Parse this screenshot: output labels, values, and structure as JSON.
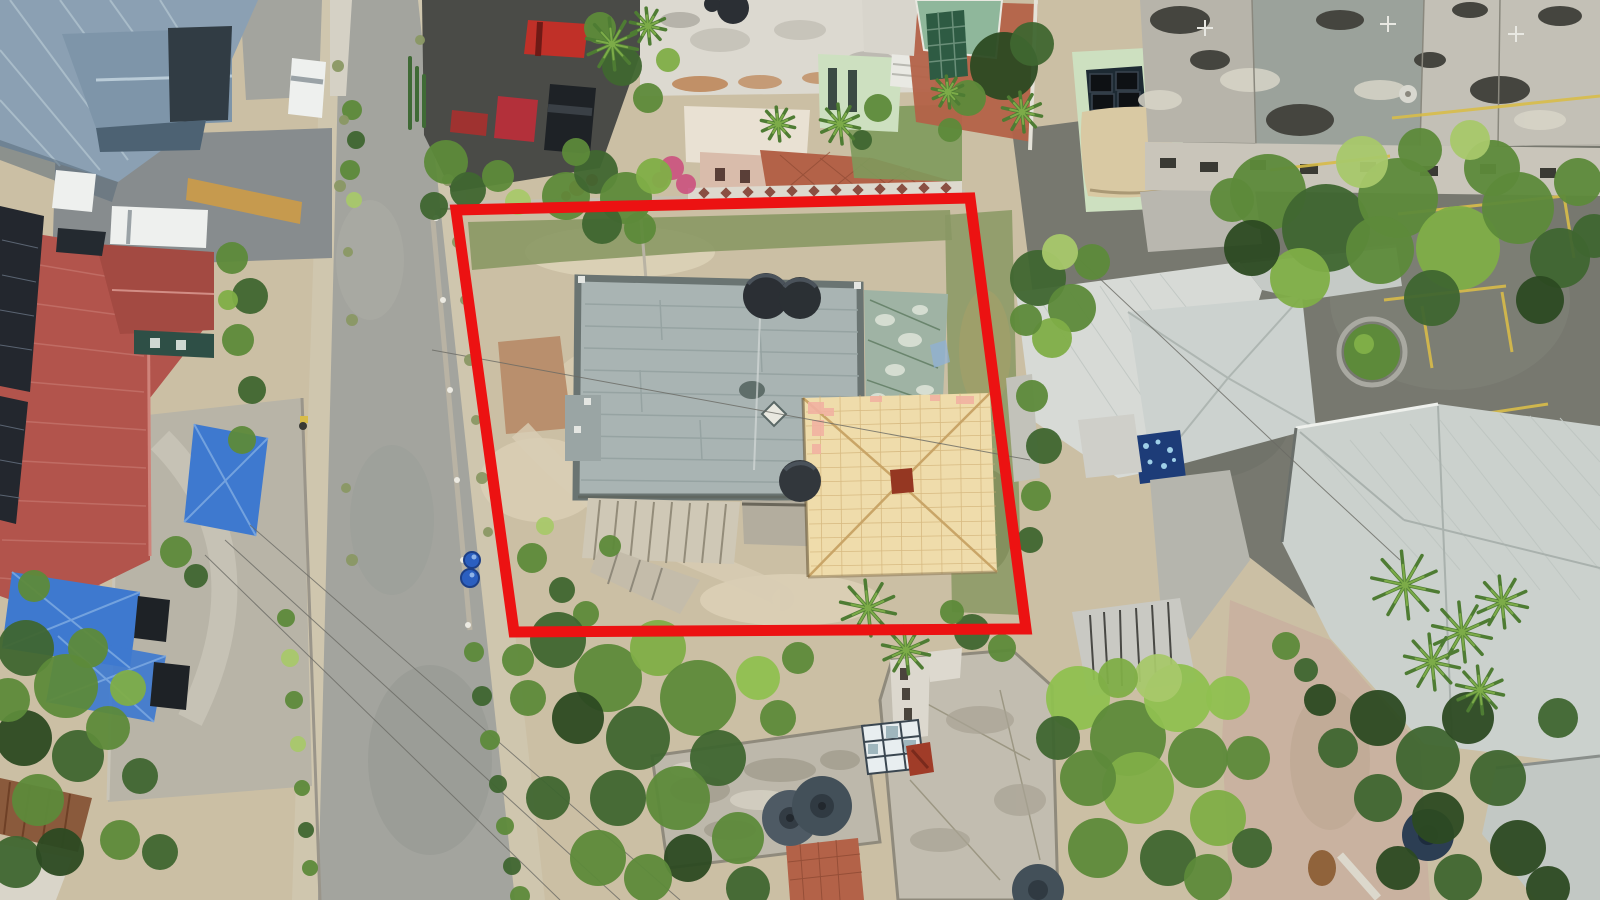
{
  "annotation": {
    "type": "property-boundary-outline",
    "points": "456,210 970,198 1026,629 514,632",
    "color": "#ec1212",
    "stroke_width": 11
  },
  "palette": {
    "ground_sand": "#cbbfa4",
    "dirt_light": "#ddd2b8",
    "dirt_red": "#b98f6d",
    "dirt_pink": "#c9b2a0",
    "grass_dull": "#8a9864",
    "lawn_green": "#7e9a5c",
    "road_gray": "#a3a49e",
    "road_dust": "#cfc6ae",
    "asphalt_dark": "#4a4b47",
    "asphalt_mid": "#77786f",
    "drive_gray": "#878c8e",
    "gravel": "#b8b4a7",
    "flat_roof_gray": "#a9b4b3",
    "parapet_dark": "#6a7472",
    "shed_green": "#9fb3a4",
    "orange_roof": "#efdcab",
    "orange_roof_line": "#d0af74",
    "chimney_rust": "#953722",
    "salmon_patch": "#f2b2a2",
    "roof_white": "#dcd9d0",
    "concrete_weathered": "#b7b4aa",
    "concrete_roof": "#bdb8ab",
    "metal_roof_white": "#d7dad6",
    "metal_roof_right": "#cbd1cd",
    "bluegray_roof": "#8ba0b3",
    "dark_roof": "#313c44",
    "red_roof": "#b2544c",
    "red_roof_dark": "#a34a42",
    "solar_dark": "#23272e",
    "tarp_blue": "#3e79cf",
    "pool_green": "#8fb79b",
    "pool_cover": "#2e5b43",
    "terracotta": "#b36248",
    "sail_tan": "#d9c9a3",
    "green_wall": "#cde0c0",
    "skylight_blue": "#9fb6bd",
    "tank_dark": "#2b2f34",
    "tank_gray": "#4e5a64",
    "tank_navy": "#2c3e53",
    "car_white": "#eef0ee",
    "car_red": "#c03028",
    "car_red2": "#b3303a",
    "car_dark": "#1e2226",
    "barrel_blue": "#2b5fc0",
    "yellow_line": "#d8bc49",
    "wall_light": "#c6c0b2",
    "ochre_wall": "#c69a4e",
    "rust_roof": "#8a5a3c",
    "pink_flower": "#cc4b7d",
    "flower_red": "#c2352b",
    "dumpster_blue": "#1d3c78",
    "tree_dark": "#3f6630",
    "tree_mid": "#5d8a3a",
    "tree_light": "#7fae47",
    "tree_bright": "#8fc050",
    "tree_yellow": "#a8c86a",
    "tree_deep": "#2c4a22",
    "palm_green": "#4e7c33",
    "palm_light": "#7cab48"
  },
  "scene": {
    "tree_color_keys": {
      "d": "tree_dark",
      "m": "tree_mid",
      "l": "tree_light",
      "b": "tree_bright",
      "y": "tree_yellow",
      "v": "tree_deep",
      "g": "grass_dull"
    },
    "trees": [
      [
        352,
        110,
        10,
        "m"
      ],
      [
        356,
        140,
        9,
        "d"
      ],
      [
        350,
        170,
        10,
        "m"
      ],
      [
        354,
        200,
        8,
        "y"
      ],
      [
        232,
        258,
        16,
        "m"
      ],
      [
        250,
        296,
        18,
        "d"
      ],
      [
        238,
        340,
        16,
        "m"
      ],
      [
        252,
        390,
        14,
        "d"
      ],
      [
        242,
        440,
        14,
        "m"
      ],
      [
        228,
        300,
        10,
        "l"
      ],
      [
        176,
        552,
        16,
        "m"
      ],
      [
        196,
        576,
        12,
        "d"
      ],
      [
        26,
        648,
        28,
        "d"
      ],
      [
        66,
        686,
        32,
        "m"
      ],
      [
        24,
        738,
        28,
        "v"
      ],
      [
        78,
        756,
        26,
        "d"
      ],
      [
        38,
        800,
        26,
        "m"
      ],
      [
        108,
        728,
        22,
        "m"
      ],
      [
        128,
        688,
        18,
        "l"
      ],
      [
        88,
        648,
        20,
        "m"
      ],
      [
        16,
        862,
        26,
        "d"
      ],
      [
        140,
        776,
        18,
        "d"
      ],
      [
        60,
        852,
        24,
        "v"
      ],
      [
        120,
        840,
        20,
        "m"
      ],
      [
        160,
        852,
        18,
        "d"
      ],
      [
        34,
        586,
        16,
        "m"
      ],
      [
        8,
        700,
        22,
        "m"
      ],
      [
        286,
        618,
        9,
        "m"
      ],
      [
        290,
        658,
        9,
        "y"
      ],
      [
        294,
        700,
        9,
        "m"
      ],
      [
        298,
        744,
        8,
        "y"
      ],
      [
        302,
        788,
        8,
        "m"
      ],
      [
        306,
        830,
        8,
        "d"
      ],
      [
        310,
        868,
        8,
        "m"
      ],
      [
        474,
        652,
        10,
        "m"
      ],
      [
        482,
        696,
        10,
        "d"
      ],
      [
        490,
        740,
        10,
        "m"
      ],
      [
        498,
        784,
        9,
        "d"
      ],
      [
        505,
        826,
        9,
        "m"
      ],
      [
        512,
        866,
        9,
        "d"
      ],
      [
        520,
        896,
        10,
        "m"
      ],
      [
        338,
        66,
        6,
        "g"
      ],
      [
        344,
        120,
        5,
        "g"
      ],
      [
        340,
        186,
        6,
        "g"
      ],
      [
        348,
        252,
        5,
        "g"
      ],
      [
        352,
        320,
        6,
        "g"
      ],
      [
        458,
        242,
        6,
        "g"
      ],
      [
        465,
        300,
        5,
        "g"
      ],
      [
        470,
        360,
        6,
        "g"
      ],
      [
        476,
        420,
        5,
        "g"
      ],
      [
        482,
        478,
        6,
        "g"
      ],
      [
        488,
        532,
        5,
        "g"
      ],
      [
        352,
        560,
        6,
        "g"
      ],
      [
        346,
        488,
        5,
        "g"
      ],
      [
        420,
        40,
        5,
        "g"
      ],
      [
        448,
        180,
        6,
        "g"
      ],
      [
        446,
        162,
        22,
        "m"
      ],
      [
        468,
        190,
        18,
        "d"
      ],
      [
        498,
        176,
        16,
        "m"
      ],
      [
        518,
        202,
        13,
        "y"
      ],
      [
        434,
        206,
        14,
        "d"
      ],
      [
        566,
        196,
        24,
        "m"
      ],
      [
        596,
        172,
        22,
        "d"
      ],
      [
        626,
        198,
        26,
        "m"
      ],
      [
        654,
        176,
        18,
        "l"
      ],
      [
        602,
        224,
        20,
        "d"
      ],
      [
        640,
        228,
        16,
        "m"
      ],
      [
        576,
        152,
        14,
        "m"
      ],
      [
        600,
        28,
        16,
        "m"
      ],
      [
        622,
        66,
        20,
        "d"
      ],
      [
        648,
        98,
        15,
        "m"
      ],
      [
        668,
        60,
        12,
        "l"
      ],
      [
        1004,
        66,
        34,
        "v"
      ],
      [
        1032,
        44,
        22,
        "d"
      ],
      [
        968,
        98,
        18,
        "m"
      ],
      [
        950,
        130,
        12,
        "m"
      ],
      [
        878,
        108,
        14,
        "m"
      ],
      [
        862,
        140,
        10,
        "d"
      ],
      [
        1268,
        192,
        38,
        "m"
      ],
      [
        1326,
        228,
        44,
        "d"
      ],
      [
        1398,
        198,
        40,
        "m"
      ],
      [
        1458,
        248,
        42,
        "l"
      ],
      [
        1518,
        208,
        36,
        "m"
      ],
      [
        1560,
        258,
        30,
        "d"
      ],
      [
        1300,
        278,
        30,
        "l"
      ],
      [
        1432,
        298,
        28,
        "d"
      ],
      [
        1362,
        162,
        26,
        "y"
      ],
      [
        1492,
        168,
        28,
        "m"
      ],
      [
        1578,
        182,
        24,
        "m"
      ],
      [
        1252,
        248,
        28,
        "v"
      ],
      [
        1232,
        200,
        22,
        "m"
      ],
      [
        1380,
        250,
        34,
        "m"
      ],
      [
        1540,
        300,
        24,
        "v"
      ],
      [
        1594,
        236,
        22,
        "d"
      ],
      [
        1470,
        140,
        20,
        "y"
      ],
      [
        1420,
        150,
        22,
        "m"
      ],
      [
        1038,
        278,
        28,
        "d"
      ],
      [
        1072,
        308,
        24,
        "m"
      ],
      [
        1052,
        338,
        20,
        "l"
      ],
      [
        1092,
        262,
        18,
        "m"
      ],
      [
        1026,
        320,
        16,
        "m"
      ],
      [
        1060,
        252,
        18,
        "y"
      ],
      [
        1032,
        396,
        16,
        "m"
      ],
      [
        1044,
        446,
        18,
        "d"
      ],
      [
        1036,
        496,
        15,
        "m"
      ],
      [
        1030,
        540,
        13,
        "d"
      ],
      [
        532,
        558,
        15,
        "m"
      ],
      [
        562,
        590,
        13,
        "d"
      ],
      [
        610,
        546,
        11,
        "m"
      ],
      [
        586,
        614,
        13,
        "m"
      ],
      [
        545,
        526,
        9,
        "y"
      ],
      [
        558,
        640,
        28,
        "d"
      ],
      [
        608,
        678,
        34,
        "m"
      ],
      [
        658,
        648,
        28,
        "l"
      ],
      [
        698,
        698,
        38,
        "m"
      ],
      [
        638,
        738,
        32,
        "d"
      ],
      [
        578,
        718,
        26,
        "v"
      ],
      [
        718,
        758,
        28,
        "d"
      ],
      [
        678,
        798,
        32,
        "m"
      ],
      [
        618,
        798,
        28,
        "d"
      ],
      [
        738,
        838,
        26,
        "m"
      ],
      [
        688,
        858,
        24,
        "v"
      ],
      [
        758,
        678,
        22,
        "b"
      ],
      [
        778,
        718,
        18,
        "m"
      ],
      [
        598,
        858,
        28,
        "m"
      ],
      [
        548,
        798,
        22,
        "d"
      ],
      [
        528,
        698,
        18,
        "m"
      ],
      [
        748,
        888,
        22,
        "d"
      ],
      [
        648,
        878,
        24,
        "m"
      ],
      [
        798,
        658,
        16,
        "m"
      ],
      [
        518,
        660,
        16,
        "m"
      ],
      [
        972,
        632,
        18,
        "d"
      ],
      [
        1002,
        648,
        14,
        "m"
      ],
      [
        952,
        612,
        12,
        "m"
      ],
      [
        1078,
        698,
        32,
        "b"
      ],
      [
        1128,
        738,
        38,
        "m"
      ],
      [
        1178,
        698,
        34,
        "b"
      ],
      [
        1138,
        788,
        36,
        "l"
      ],
      [
        1088,
        778,
        28,
        "m"
      ],
      [
        1198,
        758,
        30,
        "m"
      ],
      [
        1158,
        678,
        24,
        "y"
      ],
      [
        1218,
        818,
        28,
        "l"
      ],
      [
        1098,
        848,
        30,
        "m"
      ],
      [
        1168,
        858,
        28,
        "d"
      ],
      [
        1228,
        698,
        22,
        "b"
      ],
      [
        1248,
        758,
        22,
        "m"
      ],
      [
        1118,
        678,
        20,
        "l"
      ],
      [
        1058,
        738,
        22,
        "d"
      ],
      [
        1208,
        878,
        24,
        "m"
      ],
      [
        1252,
        848,
        20,
        "d"
      ],
      [
        1378,
        718,
        28,
        "v"
      ],
      [
        1428,
        758,
        32,
        "d"
      ],
      [
        1468,
        718,
        26,
        "v"
      ],
      [
        1498,
        778,
        28,
        "d"
      ],
      [
        1438,
        818,
        26,
        "v"
      ],
      [
        1378,
        798,
        24,
        "d"
      ],
      [
        1518,
        848,
        28,
        "v"
      ],
      [
        1458,
        878,
        24,
        "d"
      ],
      [
        1398,
        868,
        22,
        "v"
      ],
      [
        1558,
        718,
        20,
        "d"
      ],
      [
        1548,
        888,
        22,
        "v"
      ],
      [
        1338,
        748,
        20,
        "d"
      ],
      [
        1320,
        700,
        16,
        "v"
      ],
      [
        1286,
        646,
        14,
        "m"
      ],
      [
        1306,
        670,
        12,
        "d"
      ]
    ],
    "palms": [
      [
        612,
        44,
        26
      ],
      [
        648,
        26,
        18
      ],
      [
        840,
        124,
        20
      ],
      [
        778,
        124,
        17
      ],
      [
        948,
        92,
        16
      ],
      [
        1022,
        112,
        20
      ],
      [
        1405,
        585,
        34
      ],
      [
        1462,
        632,
        30
      ],
      [
        1502,
        602,
        26
      ],
      [
        1432,
        662,
        28
      ],
      [
        1480,
        690,
        24
      ],
      [
        868,
        608,
        28
      ],
      [
        906,
        650,
        24
      ]
    ]
  }
}
